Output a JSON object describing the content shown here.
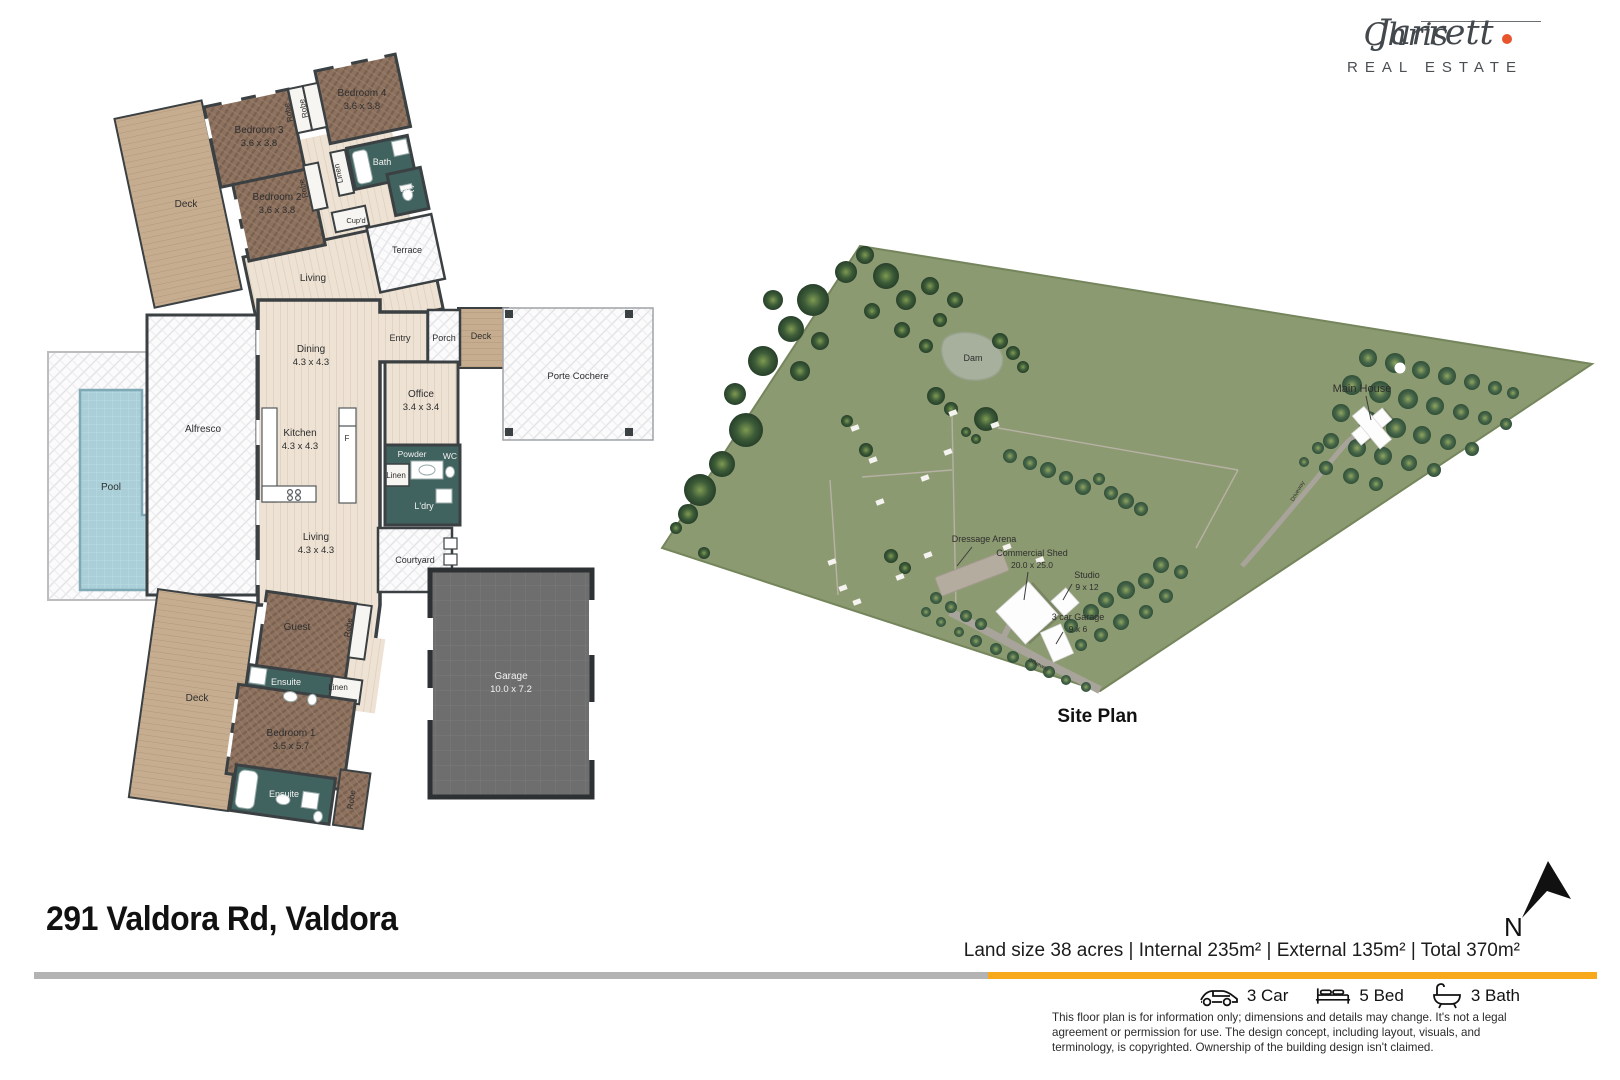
{
  "colors": {
    "accent_orange": "#F7A81B",
    "bar_gray": "#B3B3B3",
    "logo_dot": "#E8542C",
    "land_green": "#8C9A71",
    "teal_room": "#41635F",
    "wood_brown": "#8D7260",
    "deck_tan": "#C7AD8F",
    "pool_blue": "#AACFD9"
  },
  "logo": {
    "first": "Chris",
    "last": "Jarrett",
    "tagline": "REAL ESTATE"
  },
  "address": "291 Valdora Rd, Valdora",
  "summary_line": "Land size 38 acres | Internal 235m² |  External 135m² | Total 370m²",
  "stats": [
    {
      "icon": "car-icon",
      "label": "3 Car"
    },
    {
      "icon": "bed-icon",
      "label": "5 Bed"
    },
    {
      "icon": "bath-icon",
      "label": "3 Bath"
    }
  ],
  "disclaimer": "This floor plan is for information only; dimensions and details may change. It's not a legal agreement or permission for use. The design concept, including layout, visuals, and terminology, is copyrighted. Ownership of the building design isn't claimed.",
  "north_label": "N",
  "site_plan": {
    "title": "Site Plan",
    "labels": [
      {
        "n": "dam-label",
        "t": "Dam",
        "x": 973,
        "y": 361,
        "sz": 9
      },
      {
        "n": "main-house-label",
        "t": "Main House",
        "x": 1362,
        "y": 392,
        "sz": 11
      },
      {
        "n": "dressage-arena-label",
        "t": "Dressage Arena",
        "x": 984,
        "y": 542,
        "sz": 9
      },
      {
        "n": "commercial-shed-label",
        "t": "Commercial Shed",
        "s": "20.0 x 25.0",
        "x": 1032,
        "y": 556,
        "sz": 9,
        "dy": 12
      },
      {
        "n": "studio-label",
        "t": "Studio",
        "s": "9 x 12",
        "x": 1087,
        "y": 578,
        "sz": 9,
        "dy": 12
      },
      {
        "n": "garage-3car-label",
        "t": "3 car Garage",
        "s": "9 x 6",
        "x": 1078,
        "y": 620,
        "sz": 9,
        "dy": 12
      },
      {
        "n": "driveway-label",
        "t": "Driveway",
        "x": 1038,
        "y": 666,
        "sz": 5.5,
        "r": 27
      },
      {
        "n": "driveway-label",
        "t": "Driveway",
        "x": 1299,
        "y": 492,
        "sz": 5.5,
        "r": -60
      }
    ],
    "trees": [
      [
        700,
        490,
        16,
        "b"
      ],
      [
        688,
        514,
        10,
        "b"
      ],
      [
        722,
        464,
        13,
        "b"
      ],
      [
        746,
        430,
        17,
        "b"
      ],
      [
        735,
        394,
        11,
        "b"
      ],
      [
        763,
        361,
        15,
        "b"
      ],
      [
        791,
        329,
        13,
        "b"
      ],
      [
        773,
        300,
        10,
        "b"
      ],
      [
        813,
        300,
        16,
        "b"
      ],
      [
        846,
        272,
        11,
        "b"
      ],
      [
        800,
        371,
        10,
        "b"
      ],
      [
        820,
        341,
        9,
        "b"
      ],
      [
        865,
        255,
        9,
        "b"
      ],
      [
        886,
        276,
        13,
        "b"
      ],
      [
        906,
        300,
        10,
        "b"
      ],
      [
        872,
        311,
        8,
        "b"
      ],
      [
        930,
        286,
        9,
        "b"
      ],
      [
        955,
        300,
        8,
        "b"
      ],
      [
        902,
        330,
        8,
        "b"
      ],
      [
        926,
        346,
        7,
        "b"
      ],
      [
        940,
        320,
        7,
        "b"
      ],
      [
        1000,
        341,
        8,
        "b"
      ],
      [
        1013,
        353,
        7,
        "b"
      ],
      [
        1023,
        367,
        6,
        "b"
      ],
      [
        936,
        396,
        9,
        "b"
      ],
      [
        951,
        409,
        7,
        "b"
      ],
      [
        986,
        419,
        12,
        "b"
      ],
      [
        966,
        432,
        5,
        "b"
      ],
      [
        976,
        439,
        5,
        "b"
      ],
      [
        847,
        421,
        6,
        "b"
      ],
      [
        866,
        450,
        7,
        "b"
      ],
      [
        676,
        528,
        6,
        "b"
      ],
      [
        704,
        553,
        6,
        "b"
      ],
      [
        891,
        556,
        7,
        "b"
      ],
      [
        905,
        568,
        6,
        "b"
      ],
      [
        1010,
        456,
        7,
        "o"
      ],
      [
        1030,
        463,
        7,
        "o"
      ],
      [
        1048,
        470,
        8,
        "o"
      ],
      [
        1066,
        478,
        7,
        "o"
      ],
      [
        1083,
        487,
        8,
        "o"
      ],
      [
        1099,
        479,
        6,
        "o"
      ],
      [
        1111,
        493,
        7,
        "o"
      ],
      [
        1126,
        501,
        8,
        "o"
      ],
      [
        1141,
        509,
        7,
        "o"
      ],
      [
        1368,
        358,
        9,
        "o"
      ],
      [
        1395,
        363,
        10,
        "o"
      ],
      [
        1421,
        370,
        9,
        "o"
      ],
      [
        1447,
        376,
        9,
        "o"
      ],
      [
        1472,
        382,
        8,
        "o"
      ],
      [
        1495,
        388,
        7,
        "o"
      ],
      [
        1513,
        393,
        6,
        "o"
      ],
      [
        1352,
        385,
        10,
        "o"
      ],
      [
        1380,
        392,
        11,
        "o"
      ],
      [
        1408,
        399,
        10,
        "o"
      ],
      [
        1435,
        406,
        9,
        "o"
      ],
      [
        1461,
        412,
        8,
        "o"
      ],
      [
        1485,
        418,
        7,
        "o"
      ],
      [
        1506,
        424,
        6,
        "o"
      ],
      [
        1341,
        413,
        9,
        "o"
      ],
      [
        1368,
        421,
        10,
        "o"
      ],
      [
        1396,
        428,
        10,
        "o"
      ],
      [
        1422,
        435,
        9,
        "o"
      ],
      [
        1448,
        442,
        8,
        "o"
      ],
      [
        1472,
        449,
        7,
        "o"
      ],
      [
        1331,
        441,
        8,
        "o"
      ],
      [
        1357,
        448,
        9,
        "o"
      ],
      [
        1383,
        456,
        9,
        "o"
      ],
      [
        1409,
        463,
        8,
        "o"
      ],
      [
        1434,
        470,
        7,
        "o"
      ],
      [
        1326,
        468,
        7,
        "o"
      ],
      [
        1351,
        476,
        8,
        "o"
      ],
      [
        1376,
        484,
        7,
        "o"
      ],
      [
        1318,
        448,
        6,
        "o"
      ],
      [
        1304,
        462,
        5,
        "o"
      ],
      [
        1161,
        565,
        8,
        "o"
      ],
      [
        1181,
        572,
        7,
        "o"
      ],
      [
        1146,
        581,
        8,
        "o"
      ],
      [
        1126,
        590,
        9,
        "o"
      ],
      [
        1106,
        600,
        8,
        "o"
      ],
      [
        1166,
        596,
        7,
        "o"
      ],
      [
        1091,
        612,
        8,
        "o"
      ],
      [
        1146,
        612,
        7,
        "o"
      ],
      [
        1121,
        622,
        8,
        "o"
      ],
      [
        1071,
        626,
        7,
        "o"
      ],
      [
        1101,
        635,
        7,
        "o"
      ],
      [
        1081,
        645,
        6,
        "o"
      ],
      [
        1056,
        648,
        6,
        "o"
      ],
      [
        936,
        598,
        6,
        "o"
      ],
      [
        951,
        607,
        6,
        "o"
      ],
      [
        966,
        616,
        6,
        "o"
      ],
      [
        981,
        624,
        6,
        "o"
      ],
      [
        926,
        612,
        5,
        "o"
      ],
      [
        941,
        622,
        5,
        "o"
      ],
      [
        959,
        632,
        5,
        "o"
      ],
      [
        976,
        641,
        6,
        "o"
      ],
      [
        996,
        649,
        6,
        "o"
      ],
      [
        1013,
        657,
        6,
        "o"
      ],
      [
        1031,
        665,
        6,
        "o"
      ],
      [
        1049,
        672,
        6,
        "o"
      ],
      [
        1066,
        680,
        5,
        "o"
      ],
      [
        1086,
        687,
        5,
        "o"
      ]
    ],
    "gates": [
      [
        855,
        428
      ],
      [
        948,
        452
      ],
      [
        925,
        478
      ],
      [
        880,
        502
      ],
      [
        832,
        562
      ],
      [
        843,
        588
      ],
      [
        857,
        602
      ],
      [
        900,
        577
      ],
      [
        1007,
        547
      ],
      [
        1040,
        560
      ],
      [
        953,
        413
      ],
      [
        995,
        425
      ],
      [
        928,
        555
      ],
      [
        873,
        460
      ]
    ]
  },
  "floor_plan": {
    "labels": [
      {
        "n": "deck-upper-label",
        "t": "Deck",
        "x": 186,
        "y": 207
      },
      {
        "n": "bedroom3-label",
        "t": "Bedroom 3",
        "s": "3.6 x 3.8",
        "x": 259,
        "y": 133
      },
      {
        "n": "bedroom4-label",
        "t": "Bedroom 4",
        "s": "3.6 x 3.8",
        "x": 362,
        "y": 96
      },
      {
        "n": "robe-label",
        "t": "Robe",
        "x": 291,
        "y": 112,
        "r": -102,
        "sz": 8
      },
      {
        "n": "robe-label",
        "t": "Robe",
        "x": 306,
        "y": 108,
        "r": -102,
        "sz": 8
      },
      {
        "n": "bedroom2-label",
        "t": "Bedroom 2",
        "s": "3.6 x 3.8",
        "x": 277,
        "y": 200
      },
      {
        "n": "robe-label",
        "t": "Robe",
        "x": 306,
        "y": 188,
        "r": -102,
        "sz": 8
      },
      {
        "n": "linen-label",
        "t": "Linen",
        "x": 341,
        "y": 173,
        "r": -102,
        "sz": 8
      },
      {
        "n": "bath-label",
        "t": "Bath",
        "x": 382,
        "y": 165,
        "sz": 9,
        "c": "#f2f2f2"
      },
      {
        "n": "wc-label",
        "t": "WC",
        "x": 407,
        "y": 192,
        "sz": 9,
        "c": "#f2f2f2"
      },
      {
        "n": "cupd-label",
        "t": "Cup'd",
        "x": 356,
        "y": 223,
        "sz": 7.5
      },
      {
        "n": "terrace-label",
        "t": "Terrace",
        "x": 407,
        "y": 253,
        "sz": 9
      },
      {
        "n": "living-upper-label",
        "t": "Living",
        "x": 313,
        "y": 281
      },
      {
        "n": "dining-label",
        "t": "Dining",
        "s": "4.3 x 4.3",
        "x": 311,
        "y": 352
      },
      {
        "n": "kitchen-label",
        "t": "Kitchen",
        "s": "4.3 x 4.3",
        "x": 300,
        "y": 436
      },
      {
        "n": "fridge-label",
        "t": "F",
        "x": 347,
        "y": 441,
        "sz": 8
      },
      {
        "n": "entry-label",
        "t": "Entry",
        "x": 400,
        "y": 341,
        "sz": 9
      },
      {
        "n": "porch-label",
        "t": "Porch",
        "x": 444,
        "y": 341,
        "sz": 9
      },
      {
        "n": "deck-small-label",
        "t": "Deck",
        "x": 481,
        "y": 339,
        "sz": 9
      },
      {
        "n": "porte-cochere-label",
        "t": "Porte Cochere",
        "x": 578,
        "y": 379,
        "sz": 9.5
      },
      {
        "n": "office-label",
        "t": "Office",
        "s": "3.4 x 3.4",
        "x": 421,
        "y": 397
      },
      {
        "n": "powder-label",
        "t": "Powder",
        "x": 412,
        "y": 457,
        "sz": 8.5,
        "c": "#f2f2f2"
      },
      {
        "n": "wc-label",
        "t": "WC",
        "x": 450,
        "y": 459,
        "sz": 8.5,
        "c": "#f2f2f2"
      },
      {
        "n": "linen-label",
        "t": "Linen",
        "x": 396,
        "y": 478,
        "sz": 8
      },
      {
        "n": "ldry-label",
        "t": "L'dry",
        "x": 424,
        "y": 509,
        "sz": 9,
        "c": "#f2f2f2"
      },
      {
        "n": "courtyard-label",
        "t": "Courtyard",
        "x": 415,
        "y": 563,
        "sz": 9
      },
      {
        "n": "living-center-label",
        "t": "Living",
        "s": "4.3 x 4.3",
        "x": 316,
        "y": 540
      },
      {
        "n": "alfresco-label",
        "t": "Alfresco",
        "x": 203,
        "y": 432
      },
      {
        "n": "pool-label",
        "t": "Pool",
        "x": 111,
        "y": 490
      },
      {
        "n": "guest-label",
        "t": "Guest",
        "x": 297,
        "y": 630
      },
      {
        "n": "robe-label",
        "t": "Robe",
        "x": 351,
        "y": 628,
        "r": -82,
        "sz": 8
      },
      {
        "n": "ensuite-label",
        "t": "Ensuite",
        "x": 286,
        "y": 685,
        "sz": 9,
        "c": "#f2f2f2"
      },
      {
        "n": "linen-label",
        "t": "Linen",
        "x": 338,
        "y": 690,
        "sz": 8
      },
      {
        "n": "bedroom1-label",
        "t": "Bedroom 1",
        "s": "3.5 x 5.7",
        "x": 291,
        "y": 736
      },
      {
        "n": "ensuite-label",
        "t": "Ensuite",
        "x": 284,
        "y": 797,
        "sz": 9,
        "c": "#f2f2f2"
      },
      {
        "n": "robe-label",
        "t": "Robe",
        "x": 354,
        "y": 800,
        "r": -82,
        "sz": 8
      },
      {
        "n": "deck-lower-label",
        "t": "Deck",
        "x": 197,
        "y": 701
      },
      {
        "n": "garage-label",
        "t": "Garage",
        "s": "10.0 x 7.2",
        "x": 511,
        "y": 679,
        "c": "#f2f2f2"
      }
    ]
  }
}
